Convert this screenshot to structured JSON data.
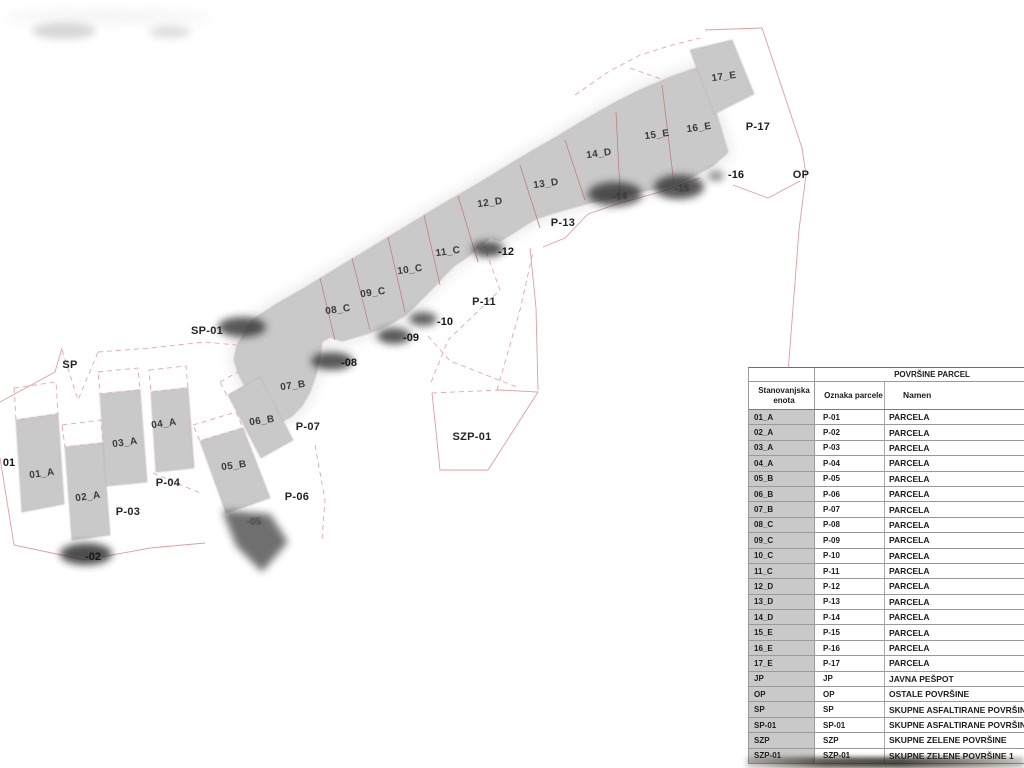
{
  "map": {
    "labels": [
      {
        "text": "01_A",
        "x": 42,
        "y": 474,
        "kind": "building"
      },
      {
        "text": "02_A",
        "x": 88,
        "y": 497,
        "kind": "building"
      },
      {
        "text": "03_A",
        "x": 125,
        "y": 443,
        "kind": "building"
      },
      {
        "text": "04_A",
        "x": 164,
        "y": 424,
        "kind": "building"
      },
      {
        "text": "05_B",
        "x": 234,
        "y": 466,
        "kind": "building"
      },
      {
        "text": "06_B",
        "x": 262,
        "y": 421,
        "kind": "building"
      },
      {
        "text": "07_B",
        "x": 293,
        "y": 386,
        "kind": "building"
      },
      {
        "text": "08_C",
        "x": 338,
        "y": 310,
        "kind": "building"
      },
      {
        "text": "09_C",
        "x": 373,
        "y": 293,
        "kind": "building"
      },
      {
        "text": "10_C",
        "x": 410,
        "y": 270,
        "kind": "building"
      },
      {
        "text": "11_C",
        "x": 448,
        "y": 252,
        "kind": "building"
      },
      {
        "text": "12_D",
        "x": 490,
        "y": 203,
        "kind": "building"
      },
      {
        "text": "13_D",
        "x": 546,
        "y": 184,
        "kind": "building"
      },
      {
        "text": "14_D",
        "x": 599,
        "y": 154,
        "kind": "building"
      },
      {
        "text": "15_E",
        "x": 657,
        "y": 135,
        "kind": "building"
      },
      {
        "text": "16_E",
        "x": 699,
        "y": 128,
        "kind": "building"
      },
      {
        "text": "17_E",
        "x": 724,
        "y": 77,
        "kind": "building"
      },
      {
        "text": "P-03",
        "x": 128,
        "y": 512,
        "kind": "parcel"
      },
      {
        "text": "P-04",
        "x": 168,
        "y": 483,
        "kind": "parcel"
      },
      {
        "text": "P-06",
        "x": 297,
        "y": 497,
        "kind": "parcel"
      },
      {
        "text": "P-07",
        "x": 308,
        "y": 427,
        "kind": "parcel"
      },
      {
        "text": "P-11",
        "x": 484,
        "y": 302,
        "kind": "parcel"
      },
      {
        "text": "P-13",
        "x": 563,
        "y": 223,
        "kind": "parcel"
      },
      {
        "text": "P-17",
        "x": 758,
        "y": 127,
        "kind": "parcel"
      },
      {
        "text": "SP",
        "x": 70,
        "y": 365,
        "kind": "area"
      },
      {
        "text": "SP-01",
        "x": 207,
        "y": 331,
        "kind": "area"
      },
      {
        "text": "SZP-01",
        "x": 472,
        "y": 437,
        "kind": "area"
      },
      {
        "text": "OP",
        "x": 801,
        "y": 175,
        "kind": "area"
      },
      {
        "text": "01",
        "x": 9,
        "y": 463,
        "kind": "partial"
      },
      {
        "text": "-02",
        "x": 93,
        "y": 557,
        "kind": "partial"
      },
      {
        "text": "-08",
        "x": 349,
        "y": 363,
        "kind": "partial"
      },
      {
        "text": "-09",
        "x": 411,
        "y": 338,
        "kind": "partial"
      },
      {
        "text": "-10",
        "x": 445,
        "y": 322,
        "kind": "partial"
      },
      {
        "text": "-12",
        "x": 506,
        "y": 252,
        "kind": "partial"
      },
      {
        "text": "-16",
        "x": 736,
        "y": 175,
        "kind": "partial"
      },
      {
        "text": "-14",
        "x": 620,
        "y": 197,
        "kind": "ghost"
      },
      {
        "text": "-15",
        "x": 682,
        "y": 189,
        "kind": "ghost"
      },
      {
        "text": "-05",
        "x": 254,
        "y": 522,
        "kind": "ghost"
      }
    ],
    "colors": {
      "building_fill": "#c9c9c9",
      "boundary_line": "#e49c9c",
      "divider_line": "#c47e7e",
      "smudge": "#2e2e2e",
      "table_unit_bg": "#c9c9c9"
    }
  },
  "table": {
    "title": "POVRŠINE PARCEL",
    "columns": [
      "Stanovanjska enota",
      "Oznaka parcele",
      "Namen"
    ],
    "rows": [
      {
        "enota": "01_A",
        "oznaka": "P-01",
        "namen": "PARCELA"
      },
      {
        "enota": "02_A",
        "oznaka": "P-02",
        "namen": "PARCELA"
      },
      {
        "enota": "03_A",
        "oznaka": "P-03",
        "namen": "PARCELA"
      },
      {
        "enota": "04_A",
        "oznaka": "P-04",
        "namen": "PARCELA"
      },
      {
        "enota": "05_B",
        "oznaka": "P-05",
        "namen": "PARCELA"
      },
      {
        "enota": "06_B",
        "oznaka": "P-06",
        "namen": "PARCELA"
      },
      {
        "enota": "07_B",
        "oznaka": "P-07",
        "namen": "PARCELA"
      },
      {
        "enota": "08_C",
        "oznaka": "P-08",
        "namen": "PARCELA"
      },
      {
        "enota": "09_C",
        "oznaka": "P-09",
        "namen": "PARCELA"
      },
      {
        "enota": "10_C",
        "oznaka": "P-10",
        "namen": "PARCELA"
      },
      {
        "enota": "11_C",
        "oznaka": "P-11",
        "namen": "PARCELA"
      },
      {
        "enota": "12_D",
        "oznaka": "P-12",
        "namen": "PARCELA"
      },
      {
        "enota": "13_D",
        "oznaka": "P-13",
        "namen": "PARCELA"
      },
      {
        "enota": "14_D",
        "oznaka": "P-14",
        "namen": "PARCELA"
      },
      {
        "enota": "15_E",
        "oznaka": "P-15",
        "namen": "PARCELA"
      },
      {
        "enota": "16_E",
        "oznaka": "P-16",
        "namen": "PARCELA"
      },
      {
        "enota": "17_E",
        "oznaka": "P-17",
        "namen": "PARCELA"
      },
      {
        "enota": "JP",
        "oznaka": "JP",
        "namen": "JAVNA PEŠPOT"
      },
      {
        "enota": "OP",
        "oznaka": "OP",
        "namen": "OSTALE POVRŠINE"
      },
      {
        "enota": "SP",
        "oznaka": "SP",
        "namen": "SKUPNE ASFALTIRANE POVRŠINE"
      },
      {
        "enota": "SP-01",
        "oznaka": "SP-01",
        "namen": "SKUPNE ASFALTIRANE POVRŠINE"
      },
      {
        "enota": "SZP",
        "oznaka": "SZP",
        "namen": "SKUPNE ZELENE POVRŠINE"
      },
      {
        "enota": "SZP-01",
        "oznaka": "SZP-01",
        "namen": "SKUPNE ZELENE POVRŠINE 1"
      }
    ]
  }
}
